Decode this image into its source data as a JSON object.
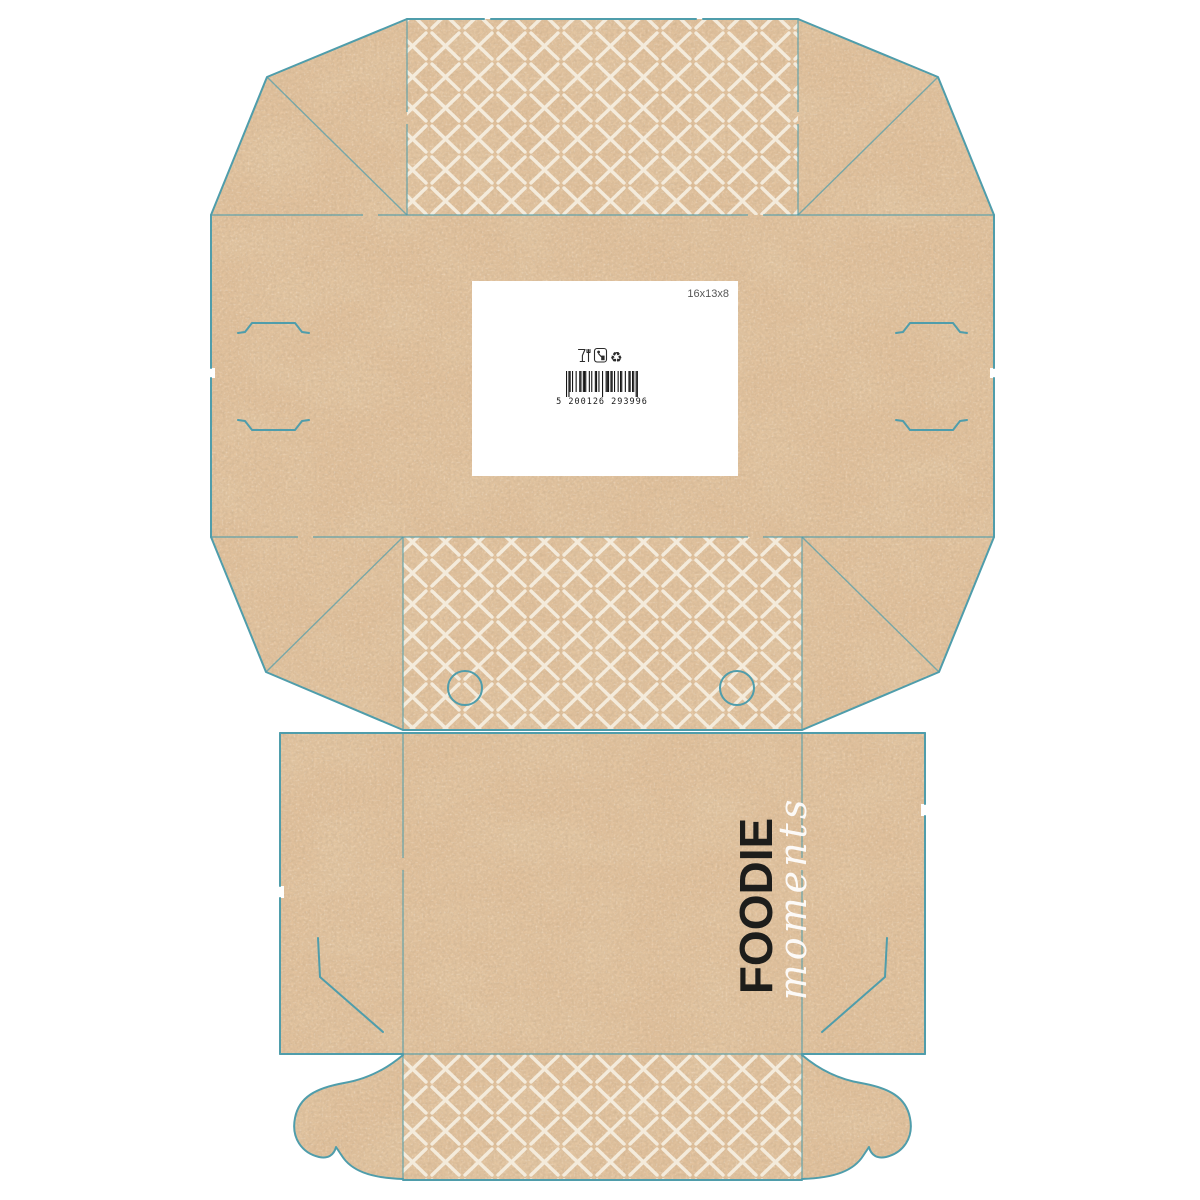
{
  "label": {
    "dimensions": "16x13x8",
    "barcode_text": "5 200126 293996",
    "icons": [
      "glass-fork-icon",
      "tidyman-icon",
      "recycle-icon"
    ]
  },
  "branding": {
    "name": "FOODIE",
    "tagline": "moments"
  },
  "colors": {
    "background": "#ffffff",
    "kraft": "#e3c39e",
    "kraft_speckle": "#b98e63",
    "cutline": "#4f9dab",
    "pattern": "#f7f0e3",
    "ink": "#1d1d1b",
    "label_bg": "#ffffff"
  }
}
